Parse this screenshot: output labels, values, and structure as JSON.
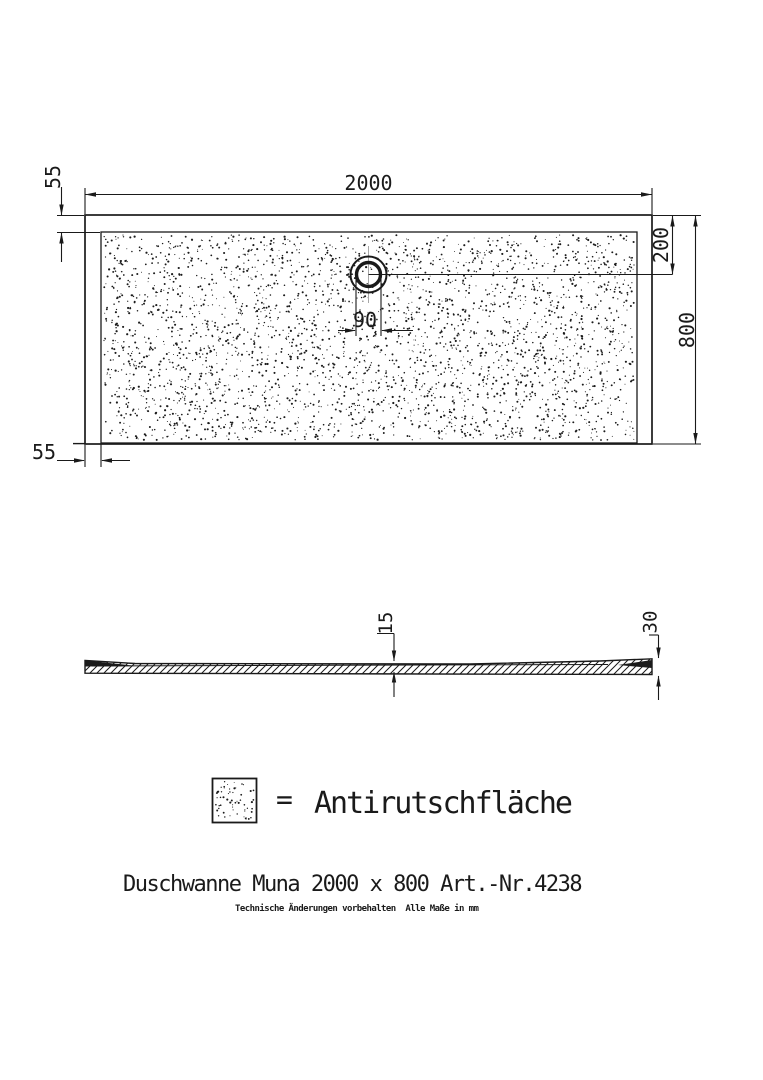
{
  "drawing": {
    "title": "Duschwanne Muna 2000 x 800 Art.-Nr.4238",
    "footnote": "Technische Änderungen vorbehalten  Alle Maße in mm",
    "legend": {
      "symbol": "antislip-dot-pattern-swatch",
      "equals_sign": "=",
      "label": "Antirutschfläche"
    },
    "top_view": {
      "dim_width": "2000",
      "dim_height": "800",
      "dim_border_top": "55",
      "dim_border_left": "55",
      "dim_drain_offset": "200",
      "dim_drain_diameter": "90"
    },
    "side_view": {
      "dim_thickness_center": "15",
      "dim_thickness_edge": "30"
    },
    "colors": {
      "line": "#1a1a1a",
      "centerline": "#a8a8a8",
      "background": "#ffffff"
    },
    "pattern": {
      "dots_main": 3200,
      "dots_legend": 60,
      "seed": 7
    }
  }
}
